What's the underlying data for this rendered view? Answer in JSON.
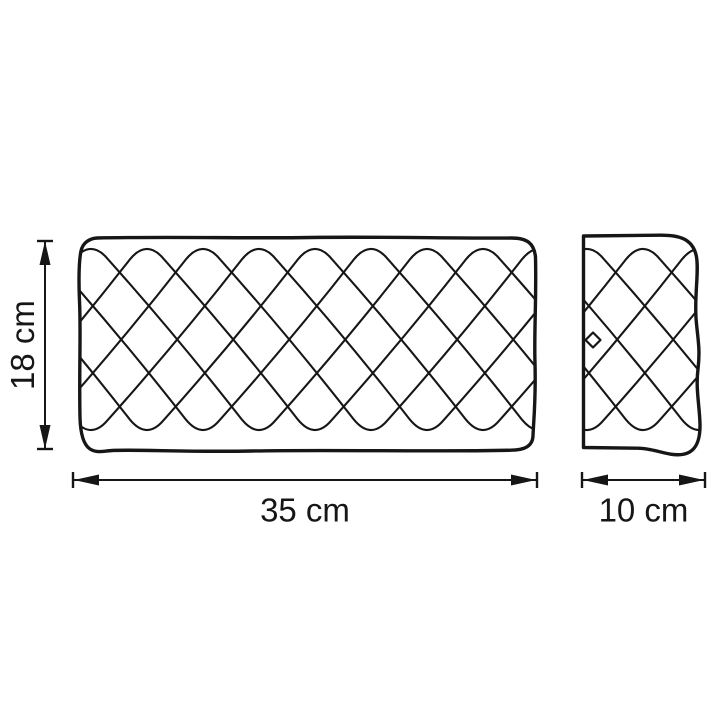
{
  "page": {
    "background_color": "#ffffff"
  },
  "drawing": {
    "line_color": "#161616",
    "views": {
      "front": {
        "width_label": "35 cm",
        "height_label": "18 cm"
      },
      "side": {
        "depth_label": "10 cm"
      }
    }
  }
}
